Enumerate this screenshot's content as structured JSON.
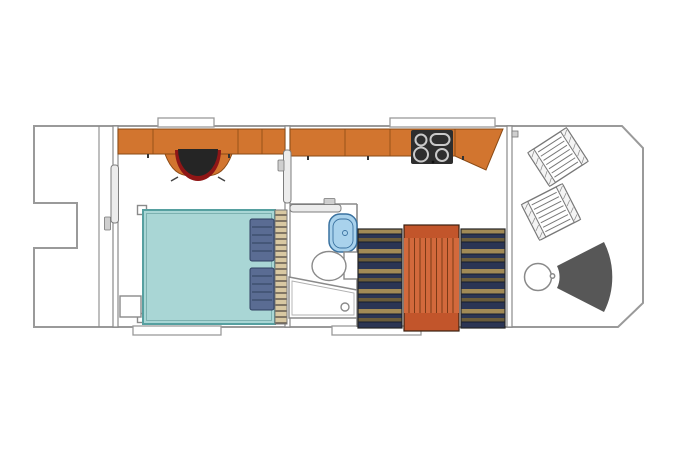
{
  "colors": {
    "hull_fill": "#ffffff",
    "wood": "#d2752f",
    "stove": "#2e2e2e",
    "chair_seat": "#252525",
    "chair_rim": "#8f1616",
    "bed": "#a9d6d5",
    "pillow": "#5a6c93",
    "pillow_line": "#3e5070",
    "headboard": "#d8c8a2",
    "bench_navy": "#2b3554",
    "bench_gold": "#a18a56",
    "bench_gold_dark": "#6b5d3b",
    "table_top": "#d2693c",
    "table_band": "#c2552b",
    "table_line": "#7c3a16",
    "sink": "#a9d2ec",
    "fan_seat": "#575757"
  },
  "furniture": {
    "bow_deck": [
      "bow-step-notch"
    ],
    "bedroom": [
      "overhead-cabinets",
      "desk",
      "desk-chair",
      "double-bed",
      "pillow",
      "pillow",
      "headboard-slats",
      "nightstand",
      "pocket-door"
    ],
    "bathroom": [
      "sliding-door",
      "sink",
      "toilet",
      "shower-tray"
    ],
    "galley": [
      "kitchen-counter",
      "cooktop",
      "corner-cabinet",
      "pocket-door",
      "dinette-bench",
      "dinette-table",
      "dinette-bench"
    ],
    "aft_deck": [
      "deck-chair",
      "deck-chair",
      "round-table",
      "fan-seat"
    ]
  }
}
